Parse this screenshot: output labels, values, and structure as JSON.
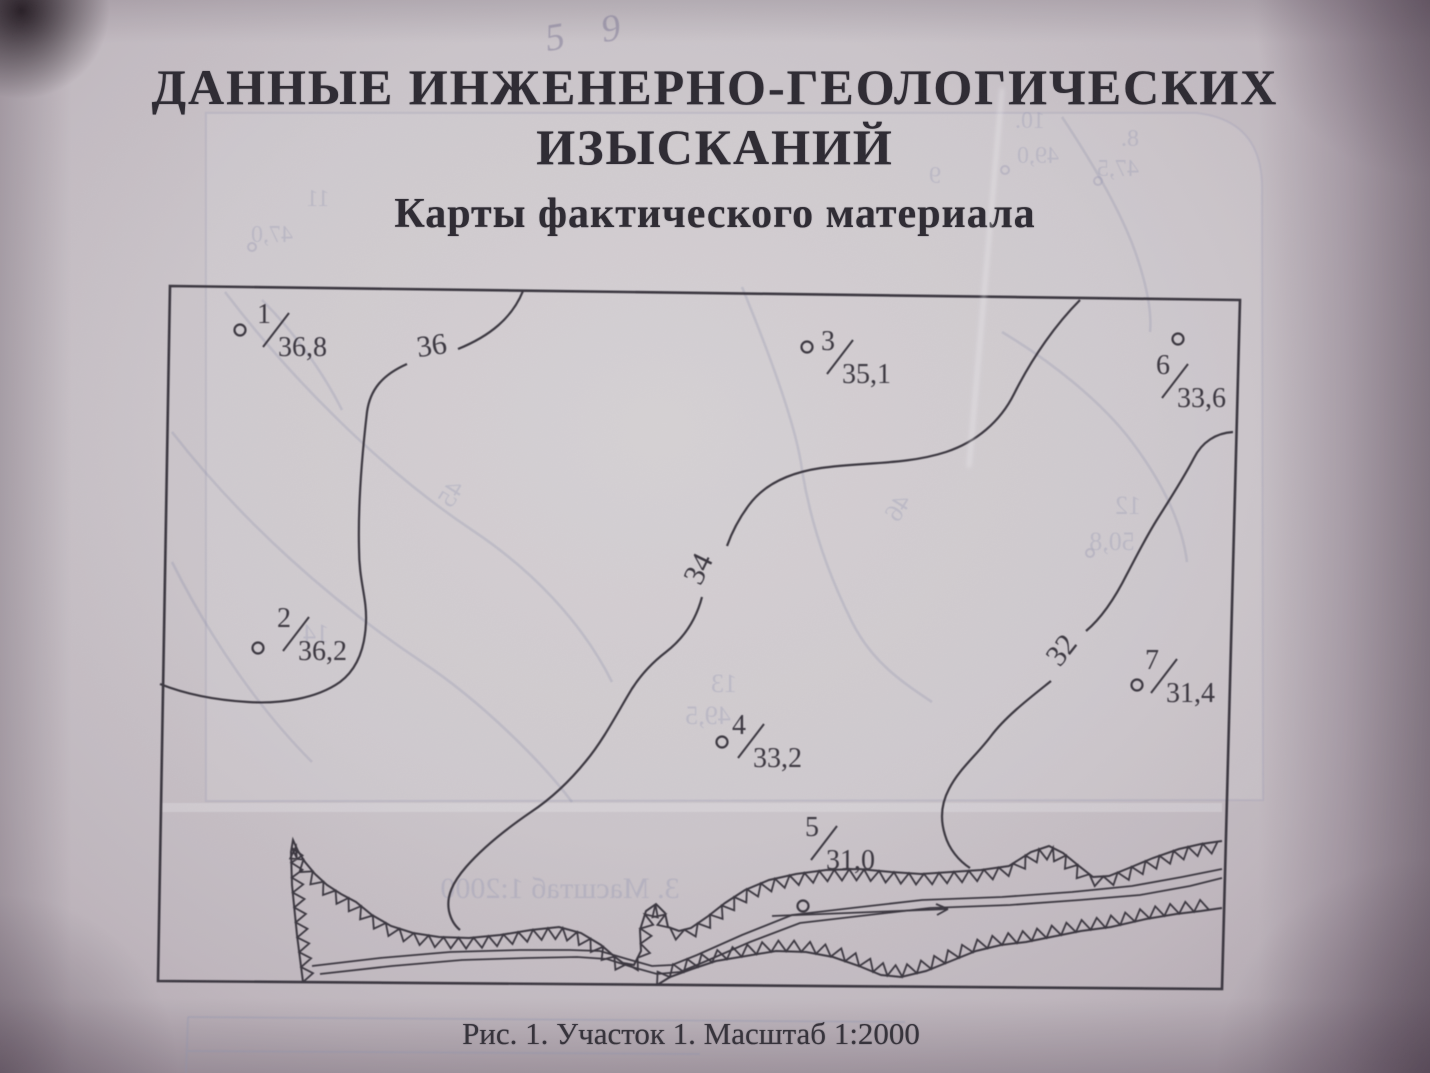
{
  "document": {
    "title_line1": "ДАННЫЕ ИНЖЕНЕРНО-ГЕОЛОГИЧЕСКИХ",
    "title_line2": "ИЗЫСКАНИЙ",
    "subtitle": "Карты фактического материала",
    "figure_caption": "Рис. 1. Участок 1. Масштаб 1:2000",
    "handwritten_note": "5 9"
  },
  "map": {
    "type": "contour_map",
    "figure_number": "Рис. 1",
    "area_label": "Участок 1",
    "scale": "1:2000",
    "boreholes": [
      {
        "id": "1",
        "elevation": "36,8",
        "cx": 240,
        "cy": 330,
        "lx": 276,
        "ly": 330
      },
      {
        "id": "2",
        "elevation": "36,2",
        "cx": 258,
        "cy": 648,
        "lx": 296,
        "ly": 634
      },
      {
        "id": "3",
        "elevation": "35,1",
        "cx": 807,
        "cy": 347,
        "lx": 840,
        "ly": 357
      },
      {
        "id": "4",
        "elevation": "33,2",
        "cx": 722,
        "cy": 742,
        "lx": 751,
        "ly": 741
      },
      {
        "id": "5",
        "elevation": "31,0",
        "cx": 803,
        "cy": 906,
        "lx": 824,
        "ly": 843
      },
      {
        "id": "6",
        "elevation": "33,6",
        "cx": 1178,
        "cy": 339,
        "lx": 1175,
        "ly": 381
      },
      {
        "id": "7",
        "elevation": "31,4",
        "cx": 1137,
        "cy": 685,
        "lx": 1164,
        "ly": 676
      }
    ],
    "contour_labels": [
      {
        "text": "36",
        "x": 433,
        "y": 355,
        "rotate": -8
      },
      {
        "text": "34",
        "x": 707,
        "y": 573,
        "rotate": -64
      },
      {
        "text": "32",
        "x": 1069,
        "y": 656,
        "rotate": -52
      }
    ]
  },
  "bleed_through": {
    "texts": [
      {
        "text": "10.",
        "x": 1030,
        "y": 128,
        "size": 24
      },
      {
        "text": "49,0",
        "x": 1038,
        "y": 163,
        "size": 24
      },
      {
        "text": "8.",
        "x": 1130,
        "y": 146,
        "size": 24
      },
      {
        "text": "47,5",
        "x": 1118,
        "y": 176,
        "size": 24
      },
      {
        "text": "9",
        "x": 935,
        "y": 183,
        "size": 24
      },
      {
        "text": "11",
        "x": 318,
        "y": 206,
        "size": 24
      },
      {
        "text": "47,0",
        "x": 272,
        "y": 242,
        "size": 24
      },
      {
        "text": "12",
        "x": 1128,
        "y": 514,
        "size": 26
      },
      {
        "text": "50,8",
        "x": 1112,
        "y": 550,
        "size": 26
      },
      {
        "text": "13",
        "x": 724,
        "y": 692,
        "size": 26
      },
      {
        "text": "49,5",
        "x": 708,
        "y": 724,
        "size": 26
      },
      {
        "text": "14",
        "x": 316,
        "y": 642,
        "size": 26
      },
      {
        "text": "46",
        "x": 905,
        "y": 512,
        "size": 26,
        "rotate": 58
      },
      {
        "text": "45",
        "x": 458,
        "y": 498,
        "size": 26,
        "rotate": 58
      },
      {
        "text": "3. Масштаб 1:2000",
        "x": 560,
        "y": 898,
        "size": 30
      }
    ]
  },
  "colors": {
    "paper": "#ccc6cb",
    "ink": "#332f38",
    "bleed": "#8f93b0"
  }
}
